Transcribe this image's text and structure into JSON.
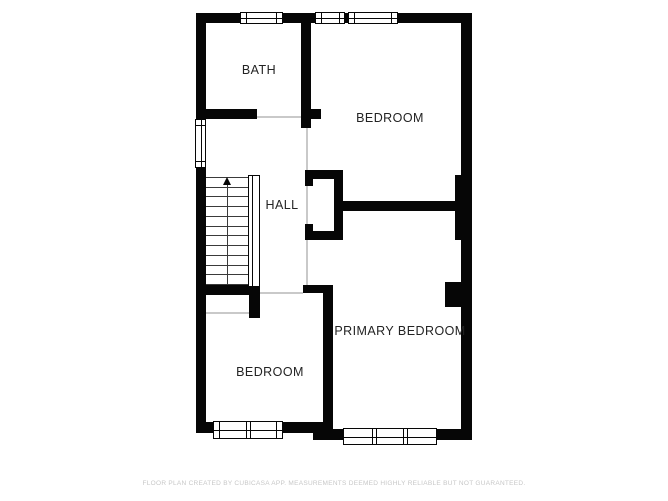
{
  "document": {
    "type": "floor-plan",
    "footer_disclaimer": "FLOOR PLAN CREATED BY CUBICASA APP. MEASUREMENTS DEEMED HIGHLY RELIABLE BUT NOT GUARANTEED."
  },
  "rooms": [
    {
      "id": "bath",
      "label": "BATH"
    },
    {
      "id": "bedroom-top",
      "label": "BEDROOM"
    },
    {
      "id": "hall",
      "label": "HALL"
    },
    {
      "id": "primary-bedroom",
      "label": "PRIMARY BEDROOM"
    },
    {
      "id": "bedroom-bottom",
      "label": "BEDROOM"
    }
  ],
  "stairs": {
    "tread_count": 11,
    "direction_arrow": "up"
  },
  "colors": {
    "wall": "#060606",
    "background": "#ffffff",
    "open_boundary_line": "#c9c9c9",
    "room_label": "#232323",
    "stair_tread": "#3a3a3a",
    "footer_text": "#c7c7c7"
  }
}
